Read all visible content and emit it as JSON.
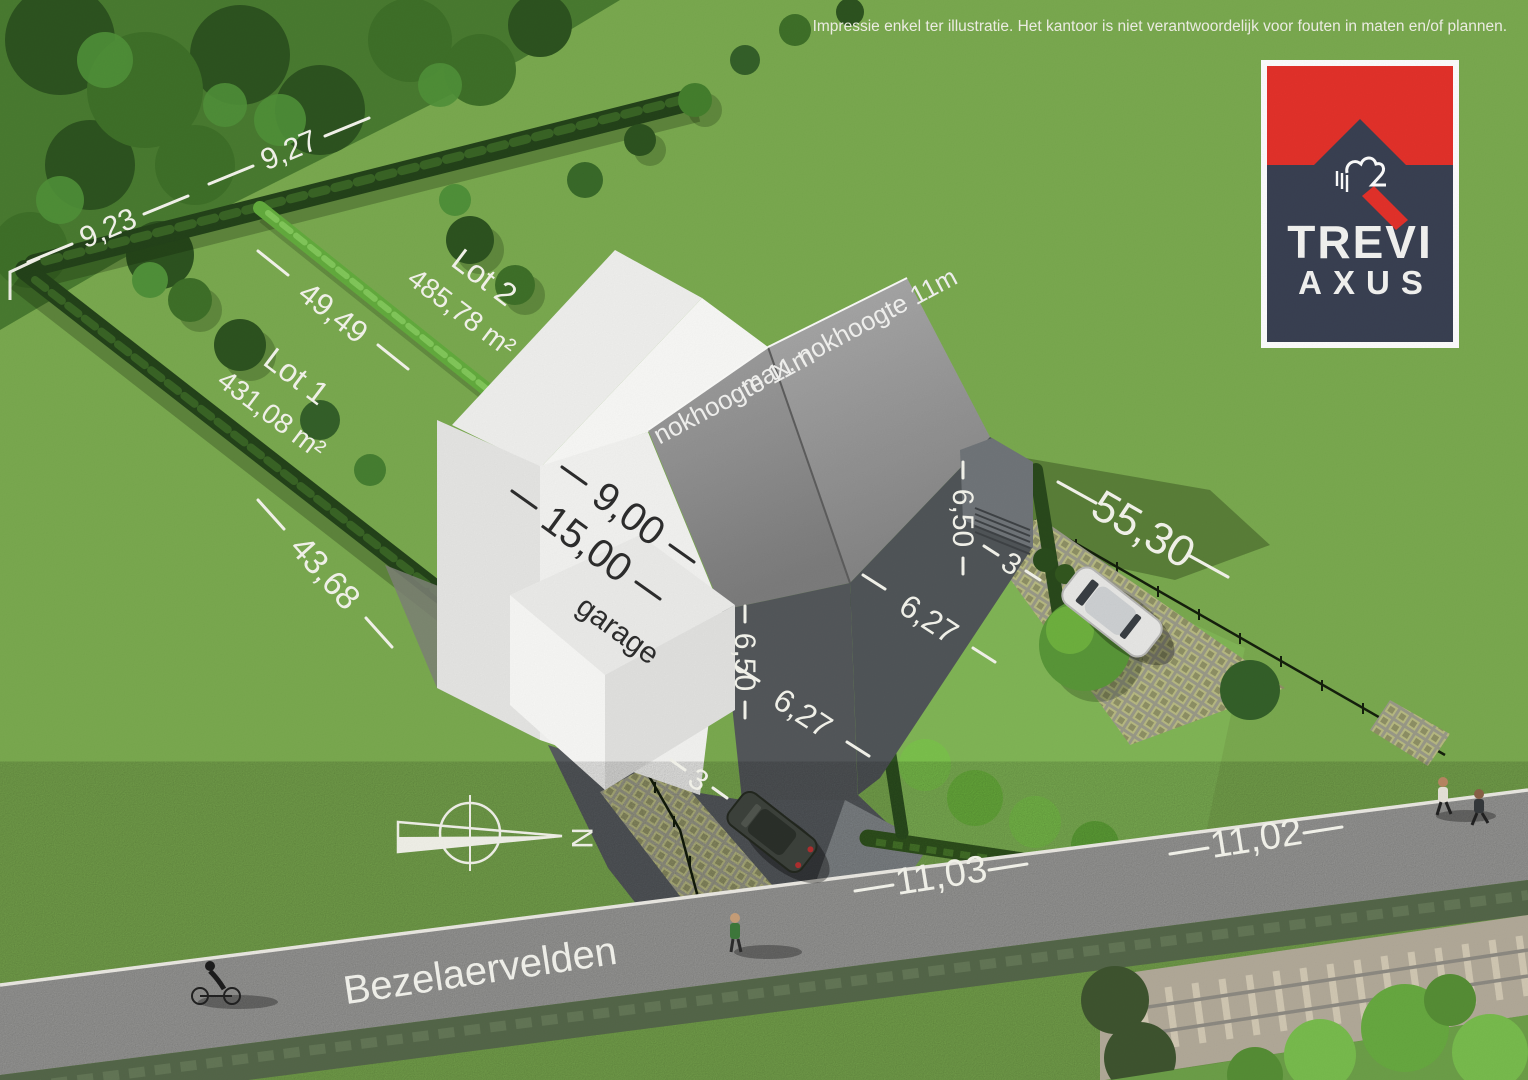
{
  "disclaimer": "Impressie enkel ter illustratie. Het kantoor is niet verantwoordelijk voor fouten in maten en/of plannen.",
  "logo": {
    "brand_top": "TREVI",
    "brand_bottom": "AXUS"
  },
  "street": {
    "name": "Bezelaervelden"
  },
  "plan": {
    "lot1": {
      "label": "Lot 1",
      "area": "431,08 m²"
    },
    "lot2": {
      "label": "Lot 2",
      "area": "485,78 m²"
    },
    "roof_note_left": "max. nokhoogte 11m",
    "roof_note_right": "max. nokhoogte 11m",
    "garage_label": "garage",
    "north_label": "N"
  },
  "dimensions": {
    "rear_left": "9,23",
    "rear_right": "9,27",
    "divider": "49,49",
    "left_boundary": "43,68",
    "right_boundary": "55,30",
    "house_depth": "15,00",
    "house_width": "9,00",
    "side_setback_left": "6,50",
    "side_setback_right": "6,50",
    "front_garden_left": "6,27",
    "front_garden_right": "6,27",
    "driveway_left": "3",
    "driveway_right": "3",
    "road_width_left": "11,03",
    "road_width_right": "11,02"
  },
  "colors": {
    "grass": "#7bab50",
    "road": "#a2a2a0",
    "logo_red": "#e5322b",
    "logo_navy": "#3a4153",
    "roof_gray": "#8f8f8f",
    "house_white": "#f4f4f2",
    "hedge_green": "#24431a"
  }
}
